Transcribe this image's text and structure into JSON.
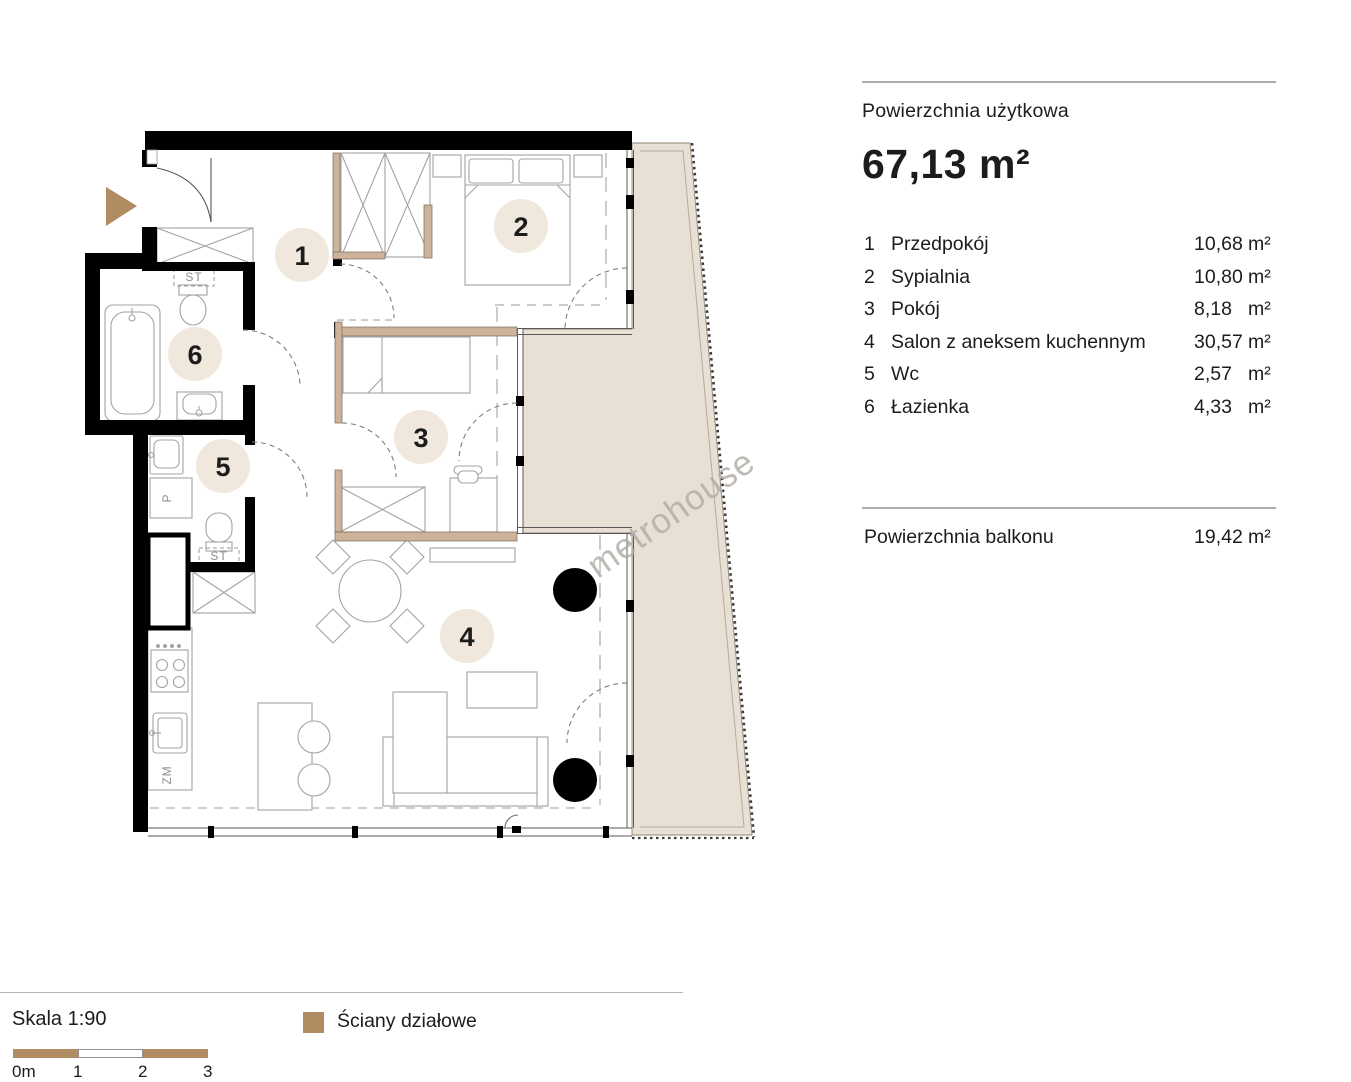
{
  "plan": {
    "watermark": "metrohouse",
    "rooms": [
      {
        "number": "1",
        "name": "Przedpokój",
        "area": "10,68",
        "unit": "m²"
      },
      {
        "number": "2",
        "name": "Sypialnia",
        "area": "10,80",
        "unit": "m²"
      },
      {
        "number": "3",
        "name": "Pokój",
        "area": "8,18",
        "unit": "m²"
      },
      {
        "number": "4",
        "name": "Salon z aneksem kuchennym",
        "area": "30,57",
        "unit": "m²"
      },
      {
        "number": "5",
        "name": "Wc",
        "area": "2,57",
        "unit": "m²"
      },
      {
        "number": "6",
        "name": "Łazienka",
        "area": "4,33",
        "unit": "m²"
      }
    ],
    "fixture_labels": {
      "st": "ST",
      "p": "P",
      "zm": "ZM"
    }
  },
  "summary": {
    "usable_area_label": "Powierzchnia użytkowa",
    "usable_area_value": "67,13 m²",
    "balcony_label": "Powierzchnia balkonu",
    "balcony_area": "19,42",
    "balcony_unit": "m²"
  },
  "footer": {
    "scale_label": "Skala 1:90",
    "scale_ticks": [
      "0m",
      "1",
      "2",
      "3"
    ],
    "legend_partition_label": "Ściany działowe"
  },
  "colors": {
    "accent_tan": "#b18c63",
    "balcony_fill": "#e9e0d5",
    "partition_wall": "#cdb39a",
    "room_marker_fill": "#f1e8dd",
    "wall_black": "#000000"
  }
}
